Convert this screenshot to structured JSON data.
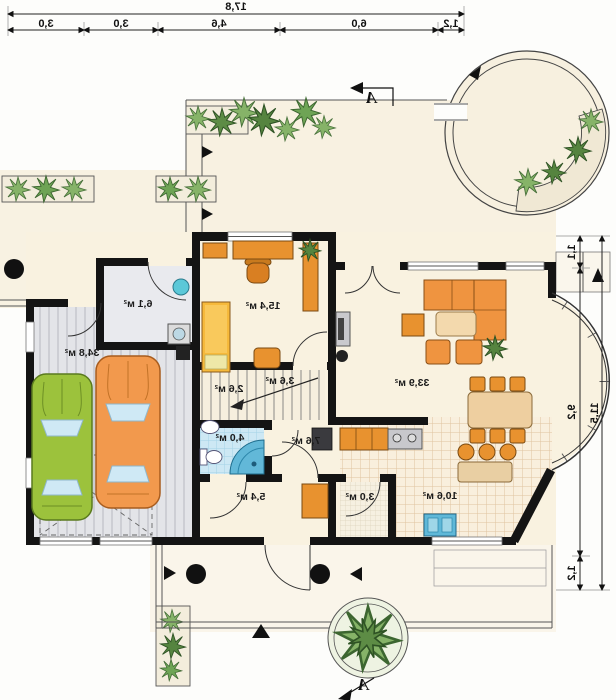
{
  "plan": {
    "type": "floor-plan (mirrored ground floor)",
    "dimensions": {
      "top": {
        "total": "17,8",
        "segments": [
          "3,0",
          "3,0",
          "4,6",
          "6,0",
          "1,2"
        ]
      },
      "right": {
        "total": "11,5",
        "segments": [
          "1,1",
          "9,2",
          "1,2"
        ]
      }
    },
    "rooms": {
      "garage": "34,8 м²",
      "utility": "6,1 м²",
      "study": "15,4 м²",
      "vestibule": "3,6 м²",
      "stairs": "2,6 м²",
      "bathroom": "4,0 м²",
      "hall": "5,4 м²",
      "corridor": "7,6 м²",
      "pantry": "3,0 м²",
      "kitchen": "10,6 м²",
      "living_room": "33,9 м²"
    },
    "section_marker": {
      "label": "A"
    },
    "colors": {
      "wall": "#141414",
      "floor_cream": "#f9f2e0",
      "furniture_orange": "#e8922f",
      "sofa_orange": "#ef9440",
      "car_green": "#9cc23c",
      "car_orange": "#f2994d",
      "bath_tile": "#cde8f4",
      "shower_blue": "#62b8d8",
      "plant_green": "#86b368"
    }
  }
}
